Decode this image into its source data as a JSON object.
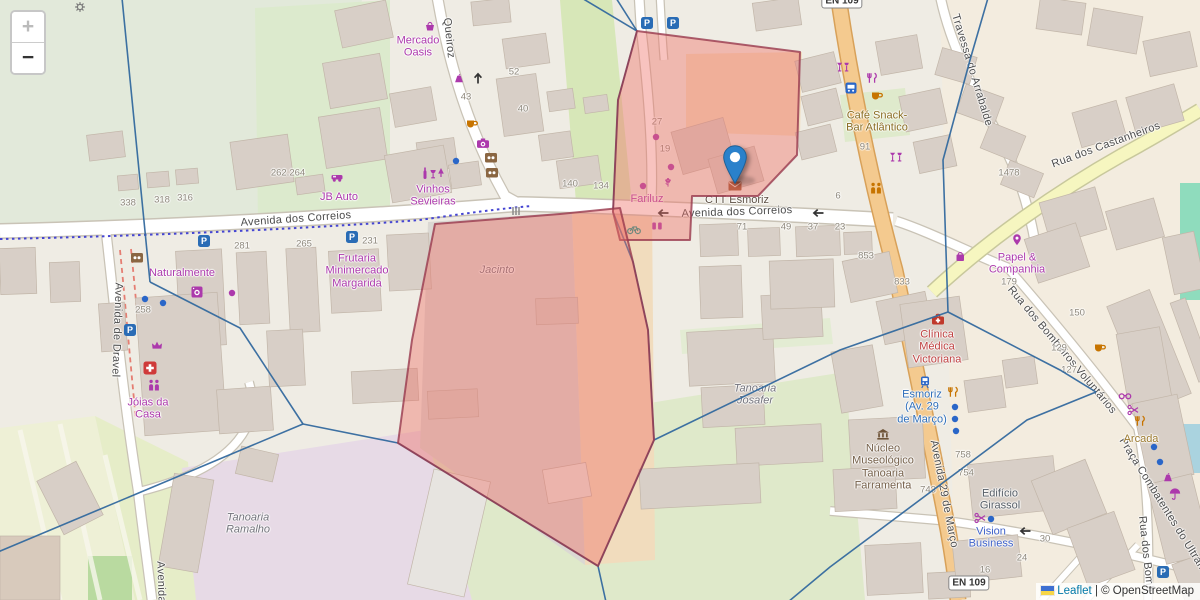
{
  "controls": {
    "zoom_in": "+",
    "zoom_out": "−"
  },
  "attribution": {
    "leaflet": "Leaflet",
    "separator": " | ",
    "osm": "© OpenStreetMap"
  },
  "glyphs": {
    "parking": "P"
  },
  "colors": {
    "boundary_line": "#33699e",
    "overlay_fill": "#ee6f66",
    "overlay_stroke": "#993a4e",
    "marker_blue": "#2a81cb",
    "shop_purple": "#ac39ac",
    "food_orange": "#c77400",
    "transport_blue": "#2a66c8",
    "health_red": "#c0392b"
  },
  "road_shields": [
    {
      "label": "EN 109",
      "x": 969,
      "y": 583
    },
    {
      "label": "EN 109",
      "x": 842,
      "y": 1
    }
  ],
  "street_labels": [
    {
      "text": "Queiroz",
      "x": 449,
      "y": 38,
      "rot": 84
    },
    {
      "text": "Avenida dos Correios",
      "x": 296,
      "y": 219,
      "rot": -4
    },
    {
      "text": "Avenida dos Correios",
      "x": 737,
      "y": 212,
      "rot": -2
    },
    {
      "text": "Avenida de Dravel",
      "x": 117,
      "y": 330,
      "rot": 92
    },
    {
      "text": "Travessa do Arrabalde",
      "x": 972,
      "y": 70,
      "rot": 73
    },
    {
      "text": "Rua dos Castanheiros",
      "x": 1106,
      "y": 145,
      "rot": -20
    },
    {
      "text": "Rua dos Bombeiros Voluntários",
      "x": 1062,
      "y": 350,
      "rot": 50
    },
    {
      "text": "Avenida 29 de Março",
      "x": 944,
      "y": 494,
      "rot": 79
    },
    {
      "text": "Praça Combatentes do Ultram",
      "x": 1163,
      "y": 505,
      "rot": 58
    },
    {
      "text": "Rua dos Bomb",
      "x": 1146,
      "y": 554,
      "rot": 84
    },
    {
      "text": "Avenida",
      "x": 161,
      "y": 582,
      "rot": 88
    }
  ],
  "place_labels": [
    {
      "text": "Mercado\nOasis",
      "x": 418,
      "y": 47,
      "color": "#ac39ac"
    },
    {
      "text": "Vinhos\nSevieiras",
      "x": 433,
      "y": 196,
      "color": "#ac39ac"
    },
    {
      "text": "JB Auto",
      "x": 339,
      "y": 197,
      "color": "#ac39ac"
    },
    {
      "text": "Naturalmente",
      "x": 182,
      "y": 273,
      "color": "#ac39ac"
    },
    {
      "text": "Frutaria\nMinimercado\nMargarida",
      "x": 357,
      "y": 271,
      "color": "#ac39ac"
    },
    {
      "text": "Jóias da\nCasa",
      "x": 148,
      "y": 409,
      "color": "#ac39ac"
    },
    {
      "text": "Fariluz",
      "x": 647,
      "y": 199,
      "color": "#ac39ac"
    },
    {
      "text": "CTT Esmoriz",
      "x": 737,
      "y": 200,
      "color": "#5d5044"
    },
    {
      "text": "Café Snack-\nBar Atlântico",
      "x": 877,
      "y": 122,
      "color": "#8a6d22"
    },
    {
      "text": "Papel &\nCompanhia",
      "x": 1017,
      "y": 264,
      "color": "#ac39ac"
    },
    {
      "text": "Clínica\nMédica\nVictoriana",
      "x": 937,
      "y": 347,
      "color": "#bf4040"
    },
    {
      "text": "Esmoriz\n(Av. 29\nde Março)",
      "x": 922,
      "y": 407,
      "color": "#2f6fba"
    },
    {
      "text": "Núcleo\nMuseológico\nTanoaria\nFarramenta",
      "x": 883,
      "y": 467,
      "color": "#75604a"
    },
    {
      "text": "Edifício\nGirassol",
      "x": 1000,
      "y": 500,
      "color": "#555d66"
    },
    {
      "text": "Vision\nBusiness",
      "x": 991,
      "y": 538,
      "color": "#3f62c9"
    },
    {
      "text": "Arcada",
      "x": 1141,
      "y": 439,
      "color": "#9c7a2e"
    },
    {
      "text": "Tanoaria\nRamalho",
      "x": 248,
      "y": 524,
      "color": "#73737c",
      "italic": true
    },
    {
      "text": "Jacinto",
      "x": 497,
      "y": 270,
      "color": "#73737c",
      "italic": true
    },
    {
      "text": "Tanoaria\nJosafer",
      "x": 755,
      "y": 395,
      "color": "#73737c",
      "italic": true
    }
  ],
  "housenumbers": [
    {
      "text": "43",
      "x": 466,
      "y": 97
    },
    {
      "text": "52",
      "x": 514,
      "y": 72
    },
    {
      "text": "40",
      "x": 523,
      "y": 109
    },
    {
      "text": "338",
      "x": 128,
      "y": 203
    },
    {
      "text": "318",
      "x": 162,
      "y": 200
    },
    {
      "text": "316",
      "x": 185,
      "y": 198
    },
    {
      "text": "262.264",
      "x": 288,
      "y": 173
    },
    {
      "text": "281",
      "x": 242,
      "y": 246
    },
    {
      "text": "265",
      "x": 304,
      "y": 244
    },
    {
      "text": "231",
      "x": 370,
      "y": 241
    },
    {
      "text": "258",
      "x": 143,
      "y": 310
    },
    {
      "text": "140",
      "x": 570,
      "y": 184
    },
    {
      "text": "134",
      "x": 601,
      "y": 186
    },
    {
      "text": "27",
      "x": 657,
      "y": 122
    },
    {
      "text": "19",
      "x": 665,
      "y": 149
    },
    {
      "text": "6",
      "x": 838,
      "y": 196
    },
    {
      "text": "71",
      "x": 742,
      "y": 227
    },
    {
      "text": "49",
      "x": 786,
      "y": 227
    },
    {
      "text": "37",
      "x": 813,
      "y": 227
    },
    {
      "text": "23",
      "x": 840,
      "y": 227
    },
    {
      "text": "853",
      "x": 866,
      "y": 256
    },
    {
      "text": "833",
      "x": 902,
      "y": 282
    },
    {
      "text": "1478",
      "x": 1009,
      "y": 173
    },
    {
      "text": "179",
      "x": 1009,
      "y": 282
    },
    {
      "text": "150",
      "x": 1077,
      "y": 313
    },
    {
      "text": "129",
      "x": 1059,
      "y": 348
    },
    {
      "text": "127",
      "x": 1069,
      "y": 370
    },
    {
      "text": "91",
      "x": 865,
      "y": 147
    },
    {
      "text": "743",
      "x": 928,
      "y": 490
    },
    {
      "text": "754",
      "x": 966,
      "y": 473
    },
    {
      "text": "758",
      "x": 963,
      "y": 455
    },
    {
      "text": "24",
      "x": 1022,
      "y": 558
    },
    {
      "text": "30",
      "x": 1045,
      "y": 539
    },
    {
      "text": "16",
      "x": 985,
      "y": 570
    }
  ],
  "icons": [
    {
      "t": "basket",
      "x": 430,
      "y": 26,
      "c": "#ac39ac"
    },
    {
      "t": "clothes",
      "x": 459,
      "y": 79,
      "c": "#ac39ac"
    },
    {
      "t": "cup",
      "x": 472,
      "y": 124,
      "c": "#c77400"
    },
    {
      "t": "camera",
      "x": 483,
      "y": 143,
      "c": "#ac39ac"
    },
    {
      "t": "brownbox",
      "x": 491,
      "y": 158,
      "c": "#8a6642"
    },
    {
      "t": "brownbox",
      "x": 492,
      "y": 173,
      "c": "#8a6642"
    },
    {
      "t": "winerow",
      "x": 434,
      "y": 173,
      "c": "#ac39ac"
    },
    {
      "t": "car",
      "x": 337,
      "y": 177,
      "c": "#ac39ac"
    },
    {
      "t": "p",
      "x": 204,
      "y": 241
    },
    {
      "t": "p",
      "x": 352,
      "y": 237
    },
    {
      "t": "p",
      "x": 647,
      "y": 23
    },
    {
      "t": "p",
      "x": 673,
      "y": 23
    },
    {
      "t": "p",
      "x": 130,
      "y": 330
    },
    {
      "t": "p",
      "x": 1163,
      "y": 572
    },
    {
      "t": "washer",
      "x": 197,
      "y": 292,
      "c": "#ac39ac"
    },
    {
      "t": "dot",
      "x": 232,
      "y": 293,
      "c": "#ac39ac"
    },
    {
      "t": "brownbox",
      "x": 137,
      "y": 258,
      "c": "#8a6642"
    },
    {
      "t": "crown",
      "x": 157,
      "y": 345,
      "c": "#ac39ac"
    },
    {
      "t": "cross",
      "x": 150,
      "y": 368,
      "c": "#cf3a3a"
    },
    {
      "t": "figures",
      "x": 154,
      "y": 385,
      "c": "#ac39ac"
    },
    {
      "t": "dot",
      "x": 145,
      "y": 299,
      "c": "#2a66c8"
    },
    {
      "t": "dot",
      "x": 163,
      "y": 303,
      "c": "#2a66c8"
    },
    {
      "t": "dot",
      "x": 456,
      "y": 161,
      "c": "#2a66c8"
    },
    {
      "t": "flower",
      "x": 668,
      "y": 182,
      "c": "#ac39ac"
    },
    {
      "t": "dot",
      "x": 656,
      "y": 137,
      "c": "#ac39ac"
    },
    {
      "t": "dot",
      "x": 671,
      "y": 167,
      "c": "#ac39ac"
    },
    {
      "t": "dot",
      "x": 643,
      "y": 186,
      "c": "#ac39ac"
    },
    {
      "t": "bicycle",
      "x": 634,
      "y": 229,
      "c": "#169a8d"
    },
    {
      "t": "chairs",
      "x": 657,
      "y": 226,
      "c": "#ac39ac"
    },
    {
      "t": "envelope",
      "x": 735,
      "y": 186,
      "c": "#9c512e"
    },
    {
      "t": "bar",
      "x": 843,
      "y": 67,
      "c": "#ac39ac"
    },
    {
      "t": "restaurant",
      "x": 872,
      "y": 78,
      "c": "#ac39ac"
    },
    {
      "t": "bus",
      "x": 851,
      "y": 88,
      "c": "#2a66c8"
    },
    {
      "t": "cup",
      "x": 877,
      "y": 96,
      "c": "#c77400"
    },
    {
      "t": "bar",
      "x": 896,
      "y": 157,
      "c": "#ac39ac"
    },
    {
      "t": "figures",
      "x": 876,
      "y": 188,
      "c": "#c77400"
    },
    {
      "t": "pin",
      "x": 1017,
      "y": 240,
      "c": "#ac39ac"
    },
    {
      "t": "bag",
      "x": 960,
      "y": 256,
      "c": "#ac39ac"
    },
    {
      "t": "medbag",
      "x": 938,
      "y": 319,
      "c": "#c0392b"
    },
    {
      "t": "train",
      "x": 925,
      "y": 382,
      "c": "#2a66c8"
    },
    {
      "t": "restaurant",
      "x": 953,
      "y": 392,
      "c": "#c77400"
    },
    {
      "t": "dot",
      "x": 955,
      "y": 407,
      "c": "#2a66c8"
    },
    {
      "t": "dot",
      "x": 955,
      "y": 419,
      "c": "#2a66c8"
    },
    {
      "t": "dot",
      "x": 956,
      "y": 431,
      "c": "#2a66c8"
    },
    {
      "t": "museum",
      "x": 883,
      "y": 434,
      "c": "#6e5438"
    },
    {
      "t": "hairdresser",
      "x": 980,
      "y": 518,
      "c": "#ac39ac"
    },
    {
      "t": "dot",
      "x": 991,
      "y": 519,
      "c": "#2a66c8"
    },
    {
      "t": "cup",
      "x": 1100,
      "y": 348,
      "c": "#c77400"
    },
    {
      "t": "glasses",
      "x": 1125,
      "y": 396,
      "c": "#ac39ac"
    },
    {
      "t": "hairdresser",
      "x": 1133,
      "y": 410,
      "c": "#ac39ac"
    },
    {
      "t": "restaurant",
      "x": 1140,
      "y": 421,
      "c": "#c77400"
    },
    {
      "t": "dot",
      "x": 1154,
      "y": 447,
      "c": "#2a66c8"
    },
    {
      "t": "dot",
      "x": 1160,
      "y": 462,
      "c": "#2a66c8"
    },
    {
      "t": "clothes",
      "x": 1168,
      "y": 478,
      "c": "#ac39ac"
    },
    {
      "t": "umbrella",
      "x": 1175,
      "y": 494,
      "c": "#ac39ac"
    },
    {
      "t": "gear",
      "x": 80,
      "y": 7,
      "c": "#7a7a7a"
    },
    {
      "t": "crossing",
      "x": 516,
      "y": 211,
      "c": "#8a8a8a"
    },
    {
      "t": "arrowl",
      "x": 663,
      "y": 213,
      "c": "#333333"
    },
    {
      "t": "arrowl",
      "x": 818,
      "y": 213,
      "c": "#333333"
    },
    {
      "t": "arrowl",
      "x": 1025,
      "y": 531,
      "c": "#333333"
    },
    {
      "t": "arrowu",
      "x": 478,
      "y": 78,
      "c": "#333333"
    }
  ],
  "overlay": {
    "polygons": [
      {
        "name": "overlay-polygon-north",
        "points": [
          [
            637,
            31
          ],
          [
            800,
            52
          ],
          [
            797,
            155
          ],
          [
            758,
            196
          ],
          [
            692,
            196
          ],
          [
            690,
            240
          ],
          [
            620,
            240
          ],
          [
            613,
            212
          ],
          [
            618,
            100
          ]
        ]
      },
      {
        "name": "overlay-polygon-south",
        "points": [
          [
            435,
            224
          ],
          [
            560,
            214
          ],
          [
            620,
            208
          ],
          [
            633,
            262
          ],
          [
            648,
            330
          ],
          [
            654,
            440
          ],
          [
            598,
            566
          ],
          [
            398,
            443
          ],
          [
            412,
            340
          ]
        ]
      }
    ],
    "boundary_lines": [
      [
        [
          122,
          -2
        ],
        [
          150,
          282
        ]
      ],
      [
        [
          150,
          282
        ],
        [
          240,
          328
        ],
        [
          303,
          424
        ]
      ],
      [
        [
          -2,
          552
        ],
        [
          303,
          424
        ]
      ],
      [
        [
          303,
          424
        ],
        [
          398,
          443
        ]
      ],
      [
        [
          398,
          443
        ],
        [
          598,
          566
        ],
        [
          606,
          602
        ]
      ],
      [
        [
          598,
          566
        ],
        [
          654,
          440
        ],
        [
          840,
          350
        ],
        [
          948,
          312
        ]
      ],
      [
        [
          948,
          312
        ],
        [
          943,
          160
        ],
        [
          970,
          60
        ],
        [
          988,
          -2
        ]
      ],
      [
        [
          948,
          312
        ],
        [
          1060,
          370
        ],
        [
          1096,
          392
        ]
      ],
      [
        [
          1096,
          392
        ],
        [
          1027,
          420
        ],
        [
          830,
          567
        ],
        [
          788,
          602
        ]
      ],
      [
        [
          575,
          -6
        ],
        [
          637,
          31
        ]
      ],
      [
        [
          616,
          -2
        ],
        [
          637,
          31
        ]
      ],
      [
        [
          637,
          31
        ],
        [
          618,
          100
        ],
        [
          613,
          212
        ],
        [
          633,
          262
        ],
        [
          648,
          330
        ],
        [
          654,
          440
        ]
      ]
    ],
    "marker": {
      "x": 735,
      "y": 183
    }
  }
}
